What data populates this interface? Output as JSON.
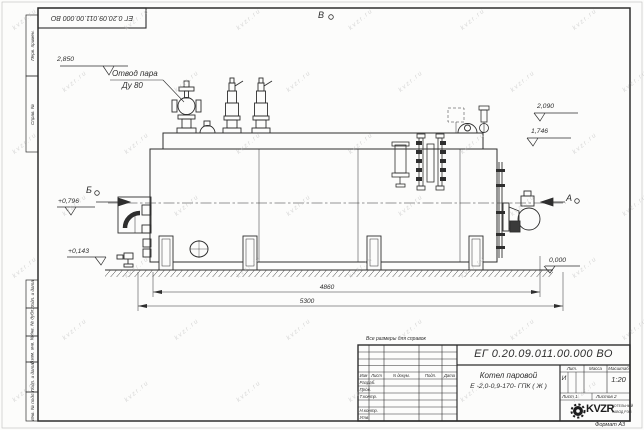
{
  "colors": {
    "line": "#2e2e2e",
    "paper": "#fcfcfb",
    "watermark": "#b9b9b9"
  },
  "watermark": {
    "text": "kvzr.ru"
  },
  "stamp": {
    "code": "ЕГ 0.20.09.011.00.000  ВО"
  },
  "margin_fields": {
    "perv_primen": "Перв. примен.",
    "sprav_no": "Справ. №",
    "podp_data_1": "Подп. и дата",
    "inv_dubl": "Инв. № дубл.",
    "vzam_inv": "Взам. инв. №",
    "podp_data_2": "Подп. и дата",
    "inv_podl": "Инв. № подл."
  },
  "drawing": {
    "labels": {
      "steam_outlet_1": "Отвод пара",
      "steam_outlet_2": "Ду 80",
      "view_top": "В",
      "view_left": "Б",
      "view_right": "А"
    },
    "elevations": {
      "e2850": "2,850",
      "e2090": "2,090",
      "e1746": "1,746",
      "e0796": "+0,796",
      "e0143": "+0,143",
      "e0000": "0,000"
    },
    "dims": {
      "d4860": "4860",
      "d5300": "5300"
    }
  },
  "note": "Все размеры для справок",
  "title_block": {
    "doc_number": "ЕГ 0.20.09.011.00.000  ВО",
    "product_name": "Котел паровой",
    "product_type": "Е -2,0-0,9-170- ГПК ( Ж )",
    "col_izm": "Изм",
    "col_list": "Лист",
    "col_ndokum": "N докум.",
    "col_podp": "Подп.",
    "col_data": "Дата",
    "row_razrab": "Разраб.",
    "row_prov": "Пров.",
    "row_tkontr": "Т.контр.",
    "row_nkontr": "Н.контр.",
    "row_utv": "Утв.",
    "lit_header": "Лит.",
    "massa_header": "Масса",
    "masshtab_header": "Масштаб",
    "lit_value": "И",
    "scale": "1:20",
    "sheet": "Лист 1",
    "sheets": "Листов 2",
    "logo": "KVZR",
    "company_1": "КОТЕЛЬНЫЙ",
    "company_2": "ЗАВОД РЭП",
    "format": "Формат А3"
  }
}
